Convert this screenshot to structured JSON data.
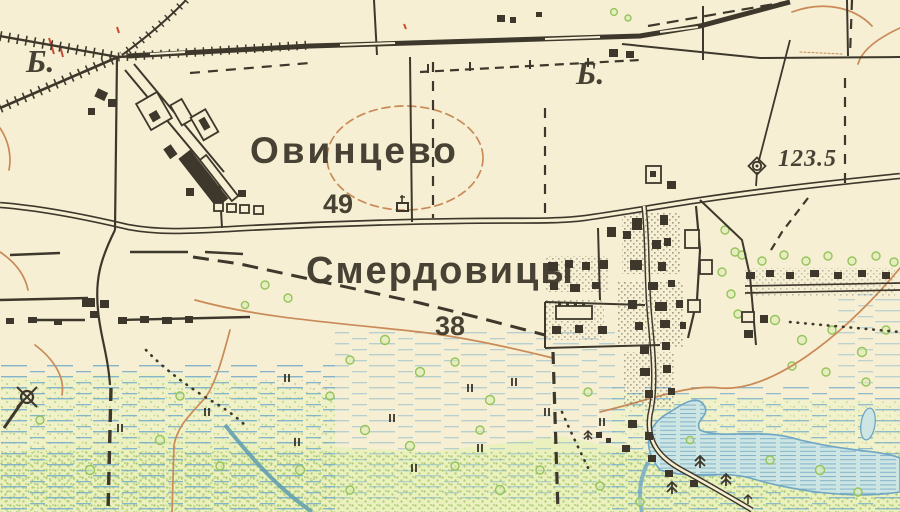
{
  "map": {
    "type": "historical topographic map",
    "language": "Russian",
    "labels": {
      "settlement_1": "Овинцево",
      "settlement_1_number": "49",
      "settlement_2": "Смердовицы",
      "settlement_2_number": "38",
      "elevation_point": "123.5",
      "abbrev_left": "Б.",
      "abbrev_right": "Б."
    },
    "colors": {
      "paper": "#f6efd3",
      "ink": "#3e382c",
      "contour": "#c98a58",
      "water_line": "#78aec9",
      "water_fill": "#cde5e3",
      "vegetation": "#9cc462"
    },
    "symbols": [
      {
        "name": "railway-line",
        "meaning": "railway with embankment hatching and station sidings"
      },
      {
        "name": "double-line-road",
        "meaning": "improved dirt road"
      },
      {
        "name": "dashed-line",
        "meaning": "boundary / field track"
      },
      {
        "name": "dotted-line",
        "meaning": "footpath"
      },
      {
        "name": "windmill-icon",
        "meaning": "windmill"
      },
      {
        "name": "geodetic-point-icon",
        "meaning": "survey / elevation point"
      },
      {
        "name": "chapel-icon",
        "meaning": "chapel"
      },
      {
        "name": "tussock-icon",
        "meaning": "marsh ticks"
      },
      {
        "name": "conifer-icon",
        "meaning": "trees"
      },
      {
        "name": "building-rect",
        "meaning": "buildings of settlement"
      }
    ]
  }
}
